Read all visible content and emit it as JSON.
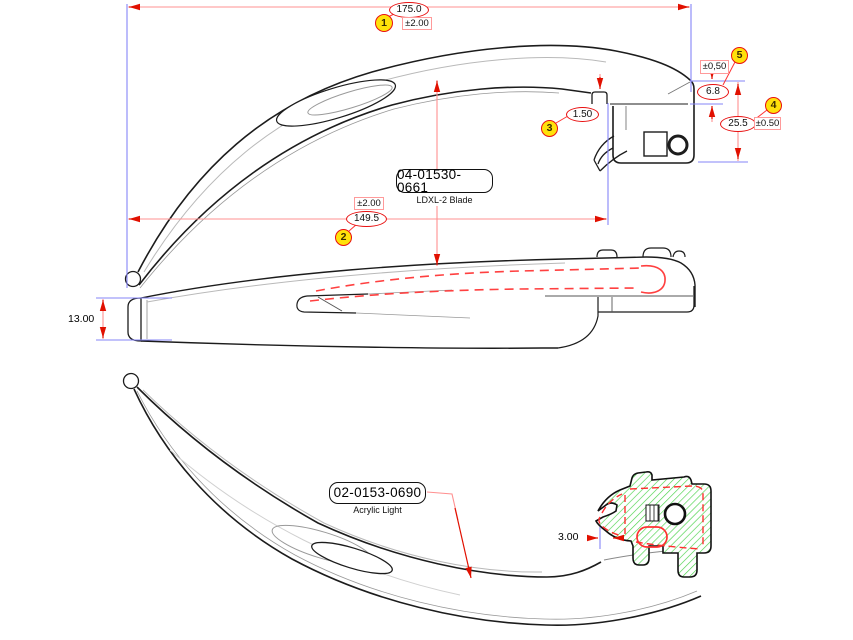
{
  "title": "LDXL-2 Blade engineering drawing",
  "balloons": {
    "b1": "1",
    "b2": "2",
    "b3": "3",
    "b4": "4",
    "b5": "5"
  },
  "dimensions": {
    "overall_length": {
      "value": "175.0",
      "tolerance": "±2.00"
    },
    "blade_length": {
      "value": "149.5",
      "tolerance": "±2.00"
    },
    "step_height": {
      "value": "1.50"
    },
    "heel_height": {
      "value": "25.5",
      "tolerance": "±0.50"
    },
    "plate_thickness": {
      "value": "6.8",
      "tolerance": "±0,50"
    },
    "blade_width": {
      "value": "13.00"
    },
    "light_inset": {
      "value": "3.00"
    }
  },
  "part_labels": {
    "blade": {
      "part_number": "04-01530-0661",
      "description": "LDXL-2 Blade"
    },
    "light": {
      "part_number": "02-0153-0690",
      "description": "Acrylic Light"
    }
  },
  "colors": {
    "outline": "#1c1c1c",
    "dimension_red": "#e81010",
    "dimension_line": "#ff9090",
    "extension_blue": "#8585f7",
    "balloon_fill": "#ffe10a",
    "hatch_green": "#4bd34b",
    "hidden_red": "#ff4040"
  }
}
